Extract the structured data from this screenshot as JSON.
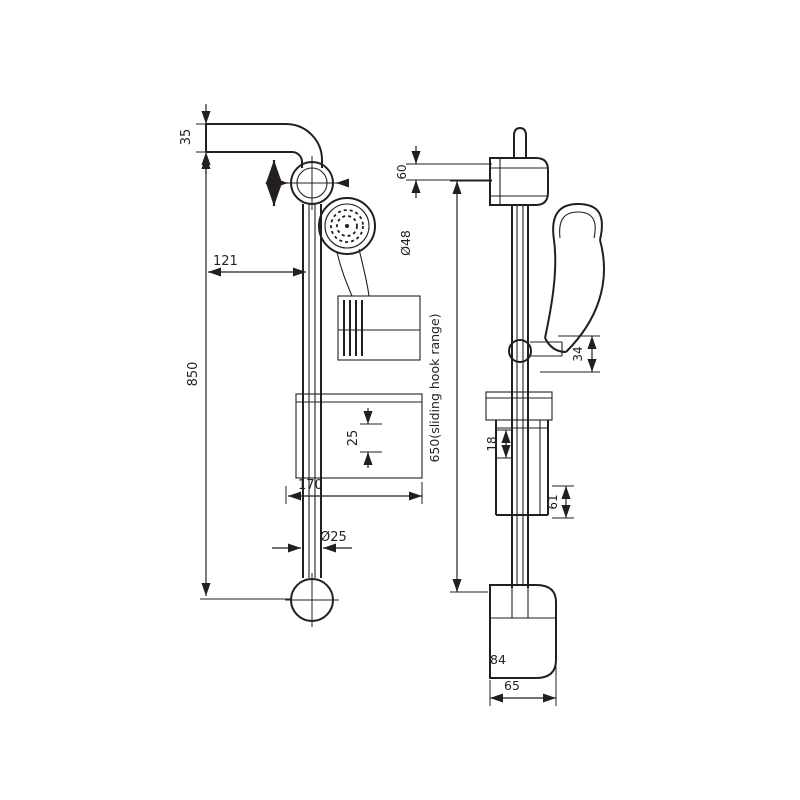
{
  "colors": {
    "background": "#ffffff",
    "line": "#231F20"
  },
  "front_view": {
    "dim_arm": "35",
    "dim_offset": "121",
    "dim_length": "850",
    "dim_slider": "25",
    "dim_dish": "170",
    "dia_pipe": "Ø25"
  },
  "side_view": {
    "dim_bracket": "60",
    "dia_flange": "Ø48",
    "range_note": "650(sliding hook range)",
    "dim_hook": "34",
    "dim_slider": "18",
    "dim_dish": "61",
    "dim_foot_height": "84",
    "dim_foot_width": "65"
  }
}
